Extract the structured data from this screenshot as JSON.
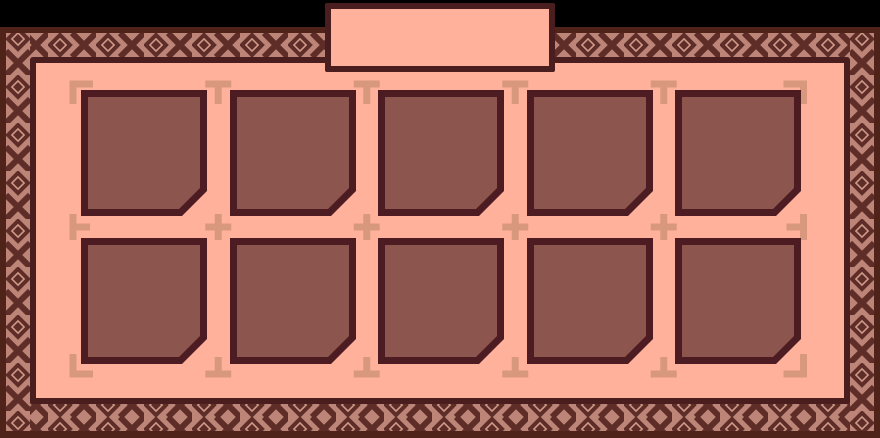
{
  "window": {
    "type": "game-inventory-panel",
    "background": "#000000"
  },
  "colors": {
    "backdrop": "#000000",
    "frame_edge": "#4f221a",
    "border_pattern_bg": "#bd8577",
    "border_pattern_dark": "#5e2d28",
    "border_pattern_diamond_inner": "#cf9b88",
    "panel_fill": "#ffb19c",
    "panel_border": "#4a1e1e",
    "slot_border": "#4c1c22",
    "slot_fill": "#8c564e",
    "guide_mark": "#d8987e"
  },
  "tab": {
    "label": ""
  },
  "inventory": {
    "rows": 2,
    "columns": 5,
    "total_slots": 10,
    "all_slots_empty": true,
    "slots": [
      {
        "id": "slot-1",
        "row": 1,
        "col": 1,
        "content": null
      },
      {
        "id": "slot-2",
        "row": 1,
        "col": 2,
        "content": null
      },
      {
        "id": "slot-3",
        "row": 1,
        "col": 3,
        "content": null
      },
      {
        "id": "slot-4",
        "row": 1,
        "col": 4,
        "content": null
      },
      {
        "id": "slot-5",
        "row": 1,
        "col": 5,
        "content": null
      },
      {
        "id": "slot-6",
        "row": 2,
        "col": 1,
        "content": null
      },
      {
        "id": "slot-7",
        "row": 2,
        "col": 2,
        "content": null
      },
      {
        "id": "slot-8",
        "row": 2,
        "col": 3,
        "content": null
      },
      {
        "id": "slot-9",
        "row": 2,
        "col": 4,
        "content": null
      },
      {
        "id": "slot-10",
        "row": 2,
        "col": 5,
        "content": null
      }
    ]
  }
}
